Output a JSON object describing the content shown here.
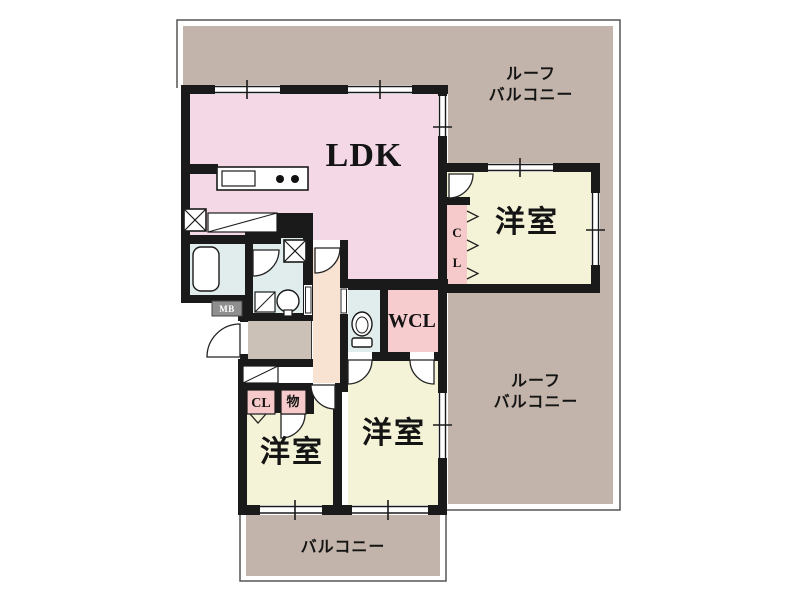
{
  "plan": {
    "type": "apartment-floor-plan",
    "labels": {
      "ldk": "LDK",
      "roof_balcony_top": {
        "line1": "ルーフ",
        "line2": "バルコニー"
      },
      "roof_balcony_right": {
        "line1": "ルーフ",
        "line2": "バルコニー"
      },
      "balcony": "バルコニー",
      "bedroom_top_right": "洋室",
      "bedroom_bottom_left": "洋室",
      "bedroom_bottom_center": "洋室",
      "walk_in_closet": "WCL",
      "closet_top_right_c": "C",
      "closet_top_right_l": "L",
      "closet_bottom_left": "CL",
      "storage": "物",
      "meter_box": "MB"
    },
    "colors": {
      "wall": "#1a1a1a",
      "ldk_pink": "#f4d8e5",
      "bedroom_cream": "#f5f3d7",
      "closet_pink": "#f6caca",
      "wcl_pink": "#f6cccf",
      "water_blue": "#e1edec",
      "hall_peach": "#f8e3d2",
      "balcony_brown": "#c2b4aa",
      "entrance_gray": "#cbc1b7",
      "outline": "#555555"
    }
  }
}
